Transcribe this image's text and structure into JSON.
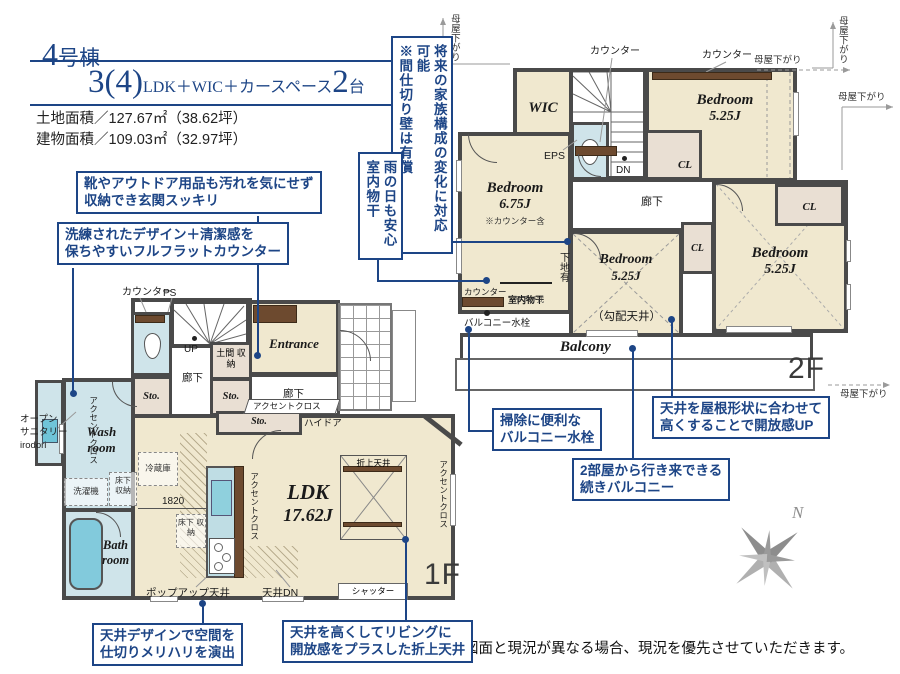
{
  "accent_color": "#1d4586",
  "wall_color": "#4a4a4a",
  "floor_color": "#f0e8cf",
  "water_color": "#cfe4ea",
  "header": {
    "building_num": "4",
    "building_suffix": "号棟",
    "plan_num": "3(4)",
    "plan_text": "LDK＋WIC＋カースペース",
    "plan_count": "2",
    "plan_count_suffix": "台",
    "land_area": "土地面積／127.67㎡（38.62坪）",
    "building_area": "建物面積／109.03㎡（32.97坪）"
  },
  "callouts": {
    "genkan": "靴やアウトドア用品も汚れを気にせず\n収納でき玄関スッキリ",
    "counter": "洗練されたデザイン＋清潔感を\n保ちやすいフルフラットカウンター",
    "future": "将来の家族構成の変化に対応可能\n※間仕切り壁は有償",
    "rainy": "雨の日も安心\n室内物干",
    "tap": "掃除に便利な\nバルコニー水栓",
    "ceiling_up": "天井を屋根形状に合わせて\n高くすることで開放感UP",
    "balcony2": "2部屋から行き来できる\n続きバルコニー",
    "merihari": "天井デザインで空間を\n仕切りメリハリを演出",
    "oriage": "天井を高くしてリビングに\n開放感をプラスした折上天井"
  },
  "plan2f": {
    "floor": "2F",
    "moya": "母屋下がり",
    "counter": "カウンター",
    "wic": "WIC",
    "eps": "EPS",
    "dn": "DN",
    "cl": "CL",
    "hall": "廊下",
    "bedroom": "Bedroom",
    "size_675": "6.75J",
    "size_525": "5.25J",
    "counter_note": "※カウンター含",
    "slope": "（勾配天井）",
    "shitaji": "下地有",
    "monohoshi": "室内物干",
    "tsurisage": "吊下げ式",
    "tap": "バルコニー水栓",
    "balcony": "Balcony"
  },
  "plan1f": {
    "floor": "1F",
    "counter": "カウンター",
    "ps": "PS",
    "up": "UP",
    "doma": "土間\n収納",
    "entrance": "Entrance",
    "hall": "廊下",
    "sto": "Sto.",
    "accent": "アクセントクロス",
    "hidoor": "ハイドア",
    "wash": "Wash\nroom",
    "sanitary": "オープン\nサニタリー\nirodori",
    "washer": "洗濯機",
    "yukashita": "床下\n収納",
    "fridge": "冷蔵庫",
    "dim": "1820",
    "bath": "Bath\nroom",
    "ldk": "LDK",
    "ldk_size": "17.62J",
    "oriage": "折上天井",
    "shutter": "シャッター",
    "popup": "ポップアップ天井",
    "ceiling_dn": "天井DN"
  },
  "compass": {
    "n": "N"
  },
  "footer": {
    "disclaimer": "図面と現況が異なる場合、現況を優先させていただきます。"
  }
}
